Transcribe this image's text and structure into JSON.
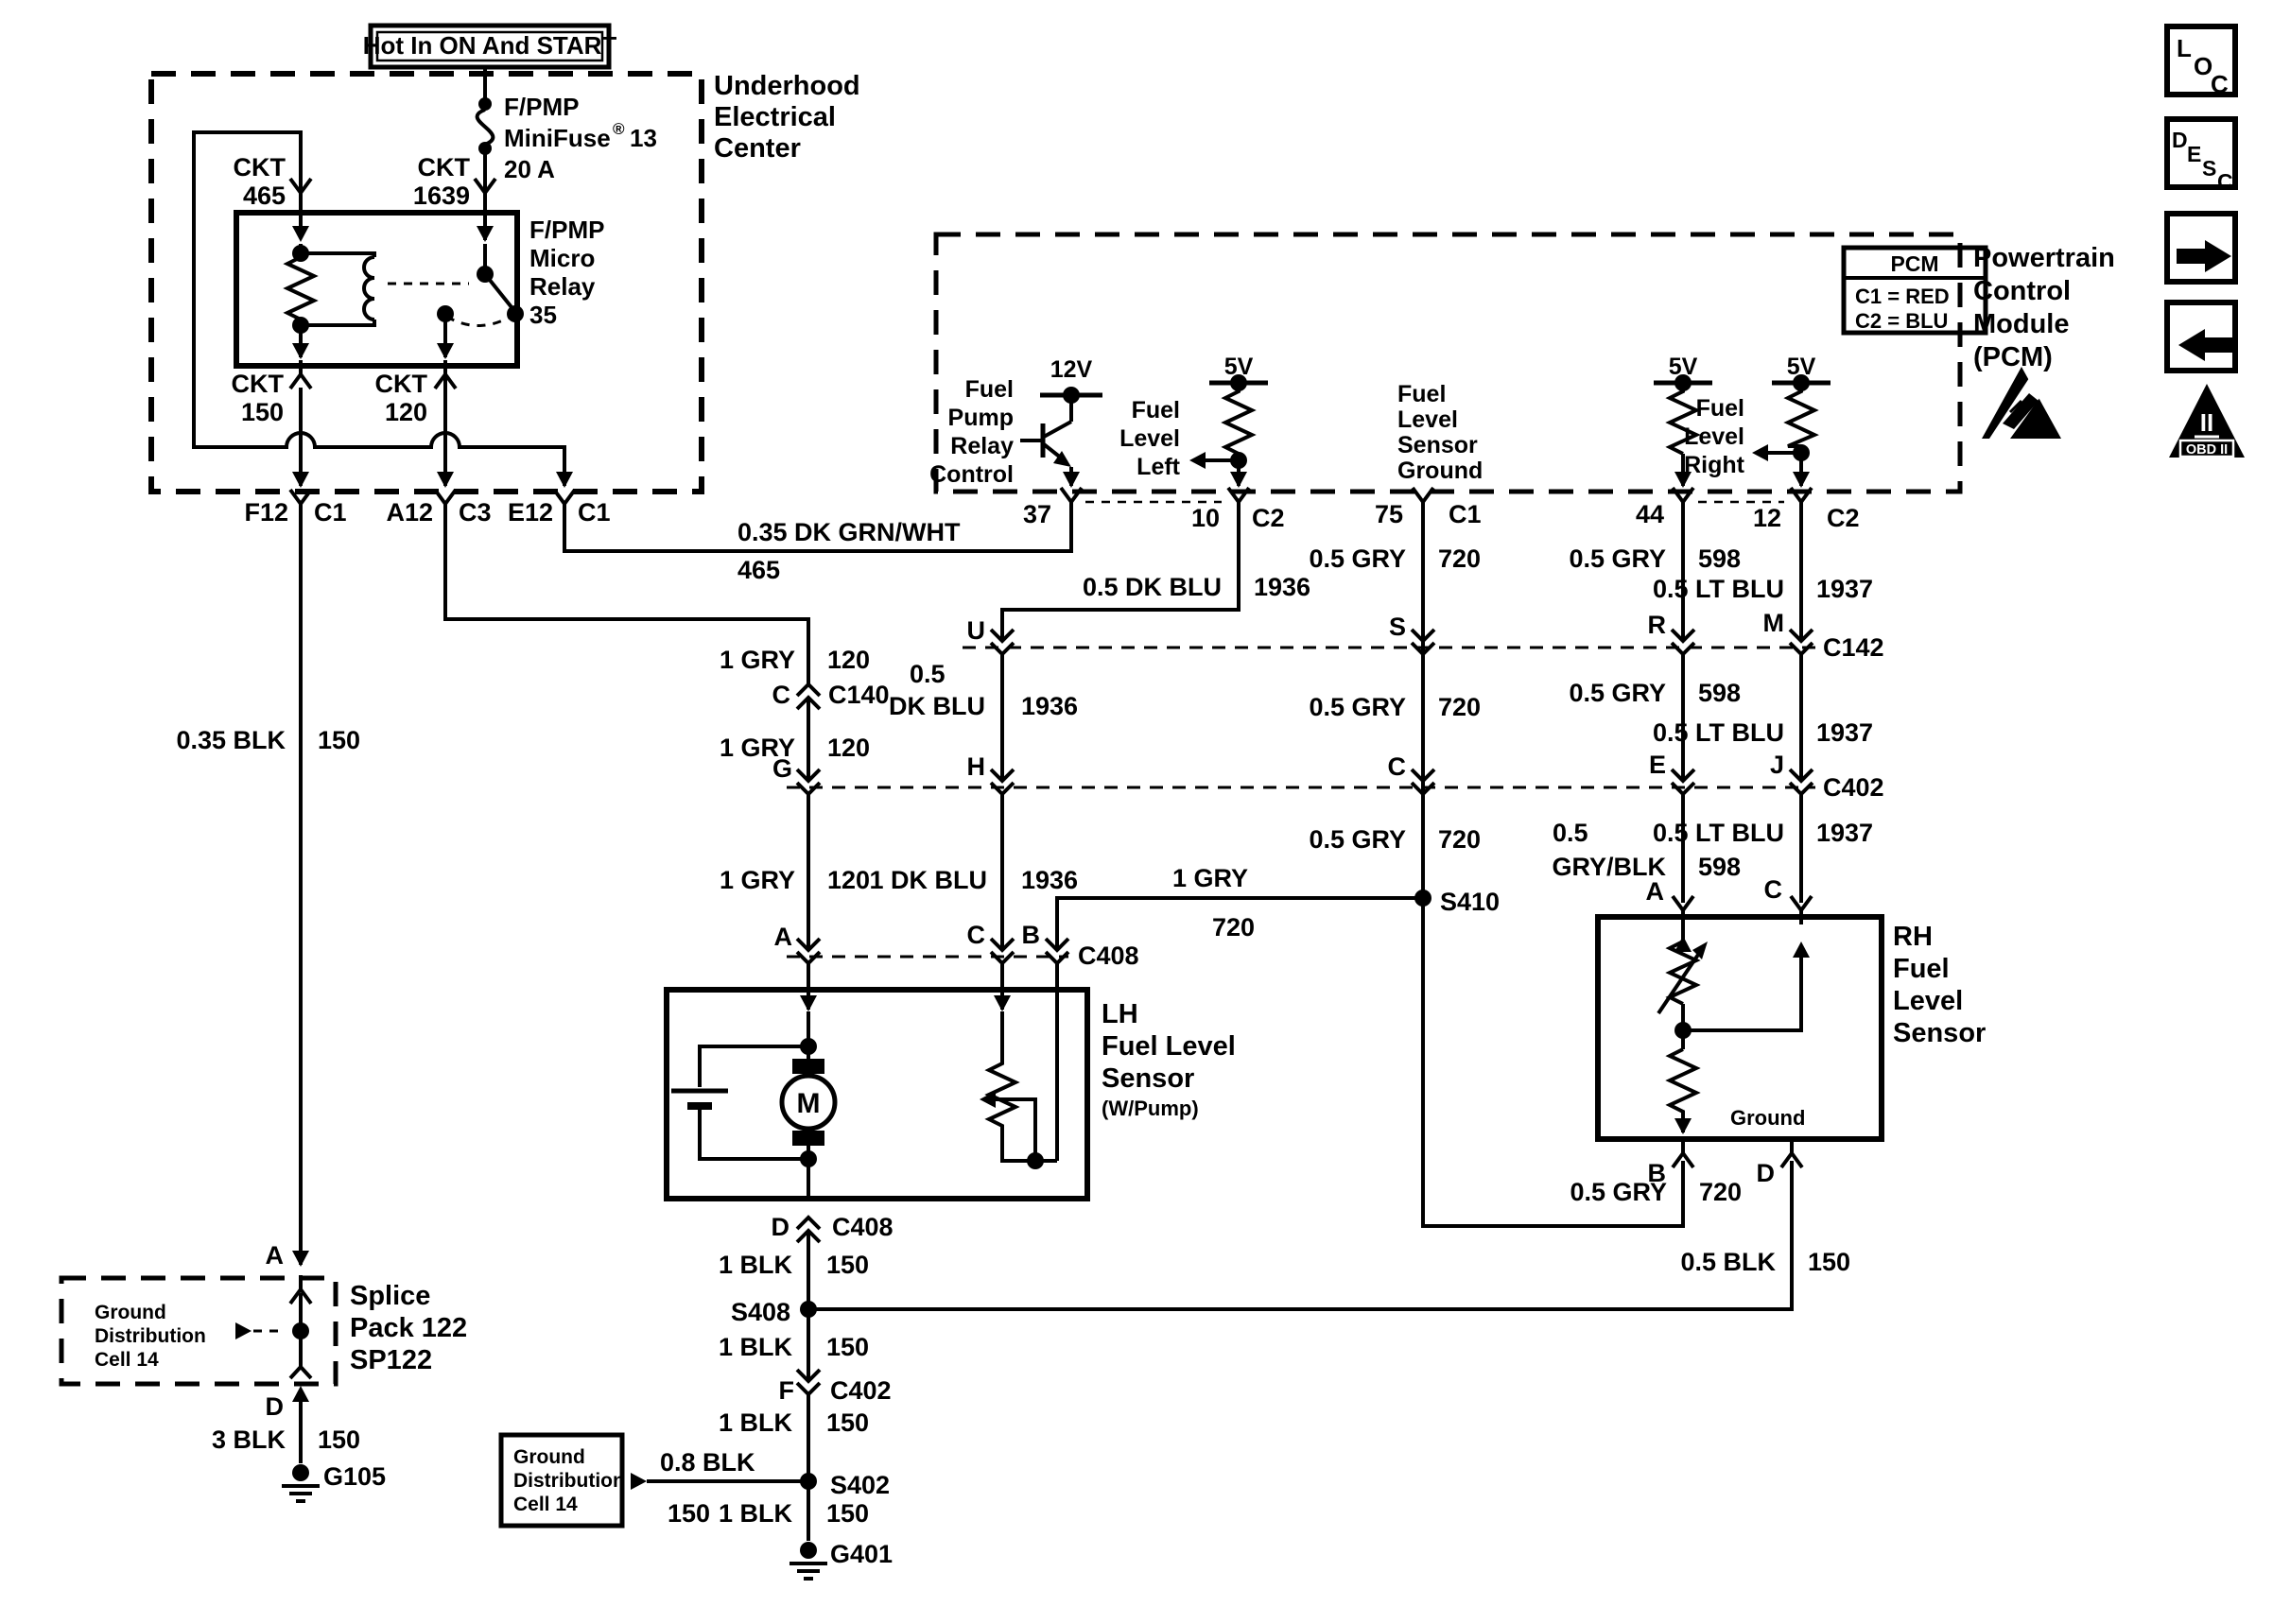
{
  "diagram_type": "automotive wiring diagram - fuel pump and fuel level sensor circuit",
  "colors": {
    "ink": "#000000",
    "paper": "#ffffff"
  },
  "power_box": {
    "label": "Hot In ON And START"
  },
  "underhood": {
    "title": [
      "Underhood",
      "Electrical",
      "Center"
    ],
    "fuse": {
      "line1": "F/PMP",
      "name": "MiniFuse",
      "reg": "®",
      "num": "13",
      "rating": "20 A"
    },
    "relay": {
      "lines": [
        "F/PMP",
        "Micro",
        "Relay",
        "35"
      ]
    },
    "ckt": {
      "k465": [
        "CKT",
        "465"
      ],
      "k1639": [
        "CKT",
        "1639"
      ],
      "k150": [
        "CKT",
        "150"
      ],
      "k120": [
        "CKT",
        "120"
      ]
    },
    "pins": {
      "f12": "F12",
      "f12c": "C1",
      "a12": "A12",
      "a12c": "C3",
      "e12": "E12",
      "e12c": "C1"
    }
  },
  "pcm": {
    "title": [
      "Powertrain",
      "Control",
      "Module",
      "(PCM)"
    ],
    "legend": {
      "title": "PCM",
      "c1": "C1 = RED",
      "c2": "C2 = BLU"
    },
    "rails": {
      "v12": "12V",
      "v5_left": "5V",
      "v5_mid": "5V",
      "v5_right": "5V"
    },
    "fuel_pump_relay_control": [
      "Fuel",
      "Pump",
      "Relay",
      "Control"
    ],
    "fuel_level_left": [
      "Fuel",
      "Level",
      "Left"
    ],
    "fuel_level_sensor_ground": [
      "Fuel",
      "Level",
      "Sensor",
      "Ground"
    ],
    "fuel_level_right": [
      "Fuel",
      "Level",
      "Right"
    ],
    "pins": {
      "p37": "37",
      "p10": "10",
      "p10c": "C2",
      "p75": "75",
      "p75c": "C1",
      "p44": "44",
      "p12": "12",
      "p12c": "C2"
    }
  },
  "wires": {
    "grn_wht": {
      "c": "0.35 DK GRN/WHT",
      "n": "465"
    },
    "gry120_a": {
      "c": "1 GRY",
      "n": "120"
    },
    "gry120_b": {
      "c": "1 GRY",
      "n": "120"
    },
    "gry120_c": {
      "c": "1 GRY",
      "n": "120"
    },
    "dkblu_a": {
      "c": "0.5 DK BLU",
      "n": "1936"
    },
    "dkblu_b": {
      "c1": "0.5",
      "c2": "DK BLU",
      "n": "1936"
    },
    "dkblu_c": {
      "c": "1 DK BLU",
      "n": "1936"
    },
    "gry720_a": {
      "c": "0.5 GRY",
      "n": "720"
    },
    "gry720_b": {
      "c": "0.5 GRY",
      "n": "720"
    },
    "gry720_c": {
      "c": "0.5 GRY",
      "n": "720"
    },
    "gry720_d": {
      "c": "1 GRY",
      "n": "720"
    },
    "gry720_e": {
      "c": "0.5 GRY",
      "n": "720"
    },
    "gry598_a": {
      "c": "0.5 GRY",
      "n": "598"
    },
    "gry598_b": {
      "c": "0.5 GRY",
      "n": "598"
    },
    "gryblk598": {
      "c1": "0.5",
      "c2": "GRY/BLK",
      "n": "598"
    },
    "ltblu_a": {
      "c": "0.5 LT BLU",
      "n": "1937"
    },
    "ltblu_b": {
      "c": "0.5 LT BLU",
      "n": "1937"
    },
    "ltblu_c": {
      "c": "0.5 LT BLU",
      "n": "1937"
    },
    "blk035": {
      "c": "0.35 BLK",
      "n": "150"
    },
    "blk05": {
      "c": "0.5 BLK",
      "n": "150"
    },
    "blk08": {
      "c": "0.8 BLK",
      "n": "150"
    },
    "blk3": {
      "c": "3 BLK",
      "n": "150"
    },
    "blk1_a": {
      "c": "1 BLK",
      "n": "150"
    },
    "blk1_b": {
      "c": "1 BLK",
      "n": "150"
    },
    "blk1_c": {
      "c": "1 BLK",
      "n": "150"
    },
    "blk1_d": {
      "c": "1 BLK",
      "n": "150"
    }
  },
  "connectors": {
    "c140": {
      "pin": "C",
      "name": "C140"
    },
    "c142": {
      "name": "C142",
      "pins": {
        "u": "U",
        "s": "S",
        "r": "R",
        "m": "M"
      }
    },
    "c402": {
      "name": "C402",
      "pins": {
        "g": "G",
        "h": "H",
        "c": "C",
        "e": "E",
        "j": "J"
      }
    },
    "c402f": {
      "pin": "F",
      "name": "C402"
    },
    "c408": {
      "name": "C408",
      "pins": {
        "a": "A",
        "c": "C",
        "b": "B"
      }
    },
    "c408d": {
      "pin": "D",
      "name": "C408"
    }
  },
  "lh_sensor": {
    "title": [
      "LH",
      "Fuel Level",
      "Sensor",
      "(W/Pump)"
    ],
    "motor": "M"
  },
  "rh_sensor": {
    "title": [
      "RH",
      "Fuel",
      "Level",
      "Sensor"
    ],
    "ground_label": "Ground",
    "pins": {
      "a": "A",
      "c": "C",
      "b": "B",
      "d": "D"
    }
  },
  "splices": {
    "s410": "S410",
    "s408": "S408",
    "s402": "S402"
  },
  "grounds": {
    "g105": "G105",
    "g401": "G401"
  },
  "splice_pack": {
    "title": [
      "Splice",
      "Pack 122",
      "SP122"
    ],
    "pin_a": "A",
    "pin_d": "D",
    "cell": [
      "Ground",
      "Distribution",
      "Cell 14"
    ]
  },
  "ground_dist_box": {
    "cell": [
      "Ground",
      "Distribution",
      "Cell 14"
    ]
  },
  "margin_icons": {
    "loc": [
      "L",
      "O",
      "C"
    ],
    "desc": [
      "D",
      "E",
      "S",
      "C"
    ],
    "obd": {
      "roman": "II",
      "label": "OBD II"
    }
  }
}
